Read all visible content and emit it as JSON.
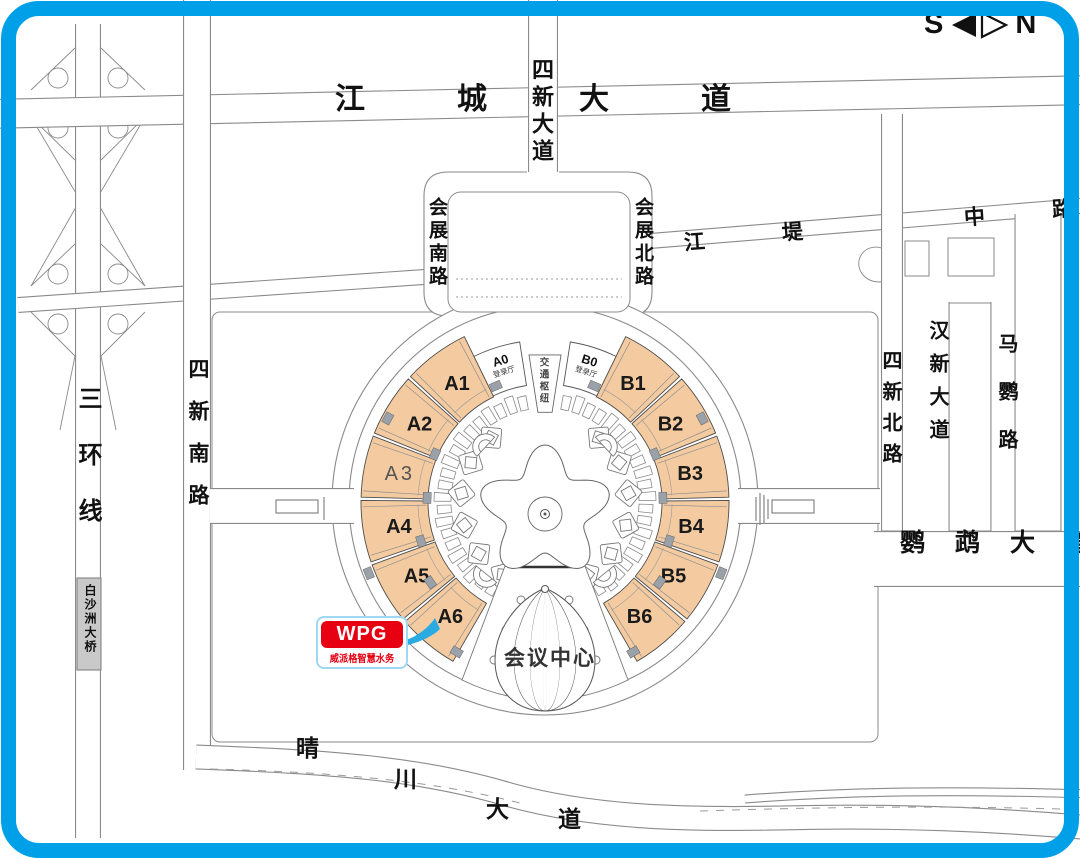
{
  "frame": {
    "color": "#00A0E9",
    "background": "#FFFFFF"
  },
  "compass": {
    "south": "S",
    "north": "N"
  },
  "logo": {
    "brand": "WPG",
    "subtitle": "威派格智慧水务",
    "red": "#E60012",
    "border_blue": "#9FD8F3",
    "arrow_blue": "#29ABE2"
  },
  "map": {
    "road_line_color": "#8A8A8A",
    "labels": [
      {
        "text": "江城大道",
        "x": 335,
        "y": 85,
        "size": 30,
        "ls": 92
      },
      {
        "text": "四新大道",
        "x": 530,
        "y": 58,
        "size": 22,
        "ls": 5,
        "vertical": true
      },
      {
        "text": "会展南路",
        "x": 427,
        "y": 197,
        "size": 19,
        "ls": 4,
        "vertical": true
      },
      {
        "text": "会展北路",
        "x": 633,
        "y": 197,
        "size": 19,
        "ls": 4,
        "vertical": true
      },
      {
        "text": "江",
        "x": 684,
        "y": 232,
        "size": 21,
        "rot": -4
      },
      {
        "text": "堤",
        "x": 782,
        "y": 222,
        "size": 21,
        "rot": -4
      },
      {
        "text": "中",
        "x": 964,
        "y": 207,
        "size": 21,
        "rot": -4
      },
      {
        "text": "路",
        "x": 1052,
        "y": 199,
        "size": 21,
        "rot": -4
      },
      {
        "text": "三环线",
        "x": 75,
        "y": 386,
        "size": 24,
        "ls": 32,
        "vertical": true
      },
      {
        "text": "白沙洲大桥",
        "x": 84,
        "y": 584,
        "size": 12,
        "ls": 2,
        "vertical": true
      },
      {
        "text": "四新南路",
        "x": 187,
        "y": 358,
        "size": 21,
        "ls": 21,
        "vertical": true
      },
      {
        "text": "四新北路",
        "x": 880,
        "y": 350,
        "size": 20,
        "ls": 11,
        "vertical": true
      },
      {
        "text": "汉新大道",
        "x": 927,
        "y": 320,
        "size": 20,
        "ls": 13,
        "vertical": true
      },
      {
        "text": "马鹦路",
        "x": 996,
        "y": 333,
        "size": 20,
        "ls": 28,
        "vertical": true
      },
      {
        "text": "鹦鹉大道",
        "x": 900,
        "y": 531,
        "size": 25,
        "ls": 30
      },
      {
        "text": "晴",
        "x": 296,
        "y": 737,
        "size": 23
      },
      {
        "text": "川",
        "x": 394,
        "y": 768,
        "size": 23
      },
      {
        "text": "大",
        "x": 486,
        "y": 798,
        "size": 23
      },
      {
        "text": "道",
        "x": 558,
        "y": 808,
        "size": 23
      },
      {
        "text": "交通枢纽",
        "x": 538,
        "y": 357,
        "size": 9.5,
        "ls": 2.5,
        "vertical": true,
        "color": "#444444"
      },
      {
        "text": "会议中心",
        "x": 504,
        "y": 648,
        "size": 21,
        "ls": 2,
        "color": "#333333"
      }
    ],
    "venue": {
      "cx": 545,
      "cy": 502,
      "ring_outer_r": 213,
      "ring_inner_r": 196,
      "hall_r0": 117,
      "hall_r1": 184,
      "hall_label_r": 148,
      "hall_fill": "#F4CBA0",
      "hall_stroke": "#4D4D4D",
      "connector_fill": "#9BA1A9",
      "halls": [
        {
          "id": "A1",
          "start": 313,
          "end": 334
        },
        {
          "id": "A2",
          "start": 292,
          "end": 312
        },
        {
          "id": "A3",
          "start": 271.5,
          "end": 291,
          "thin": true
        },
        {
          "id": "A4",
          "start": 251,
          "end": 270.5
        },
        {
          "id": "A5",
          "start": 230.5,
          "end": 250
        },
        {
          "id": "A6",
          "start": 210,
          "end": 229.5
        },
        {
          "id": "B1",
          "start": 26,
          "end": 47
        },
        {
          "id": "B2",
          "start": 48,
          "end": 68
        },
        {
          "id": "B3",
          "start": 69,
          "end": 88.5
        },
        {
          "id": "B4",
          "start": 89.5,
          "end": 109
        },
        {
          "id": "B5",
          "start": 110,
          "end": 129.5
        },
        {
          "id": "B6",
          "start": 130.5,
          "end": 150
        }
      ],
      "lobbies": [
        {
          "id": "A0",
          "sub": "登录厅",
          "start": 334,
          "end": 351,
          "r0": 118,
          "r1": 162
        },
        {
          "id": "B0",
          "sub": "登录厅",
          "start": 9,
          "end": 26,
          "r0": 118,
          "r1": 162
        }
      ],
      "ring_segments": {
        "ranges": [
          [
            12,
            148.5
          ],
          [
            211.5,
            348
          ]
        ],
        "step": 6.8,
        "r0": 94,
        "r1": 111,
        "halfw": 2.3
      },
      "pavilion_angles": [
        40,
        62,
        84,
        106,
        128,
        150,
        -40,
        -62,
        -84,
        -106,
        -128,
        -150
      ],
      "pavilion_r": 84,
      "fans": [
        {
          "a": 47,
          "r": 88
        },
        {
          "a": -47,
          "r": 88
        },
        {
          "a": 141,
          "r": 100
        },
        {
          "a": -141,
          "r": 100
        }
      ],
      "connectors": [
        [
          298,
          178
        ],
        [
          293.5,
          120
        ],
        [
          272,
          118
        ],
        [
          252.5,
          130
        ],
        [
          248,
          190
        ],
        [
          235,
          140
        ],
        [
          210.5,
          174
        ],
        [
          62,
          178
        ],
        [
          66.5,
          120
        ],
        [
          88,
          118
        ],
        [
          107.5,
          130
        ],
        [
          112,
          190
        ],
        [
          125,
          140
        ],
        [
          149.5,
          174
        ],
        [
          337,
          126
        ],
        [
          23,
          126
        ]
      ]
    }
  }
}
